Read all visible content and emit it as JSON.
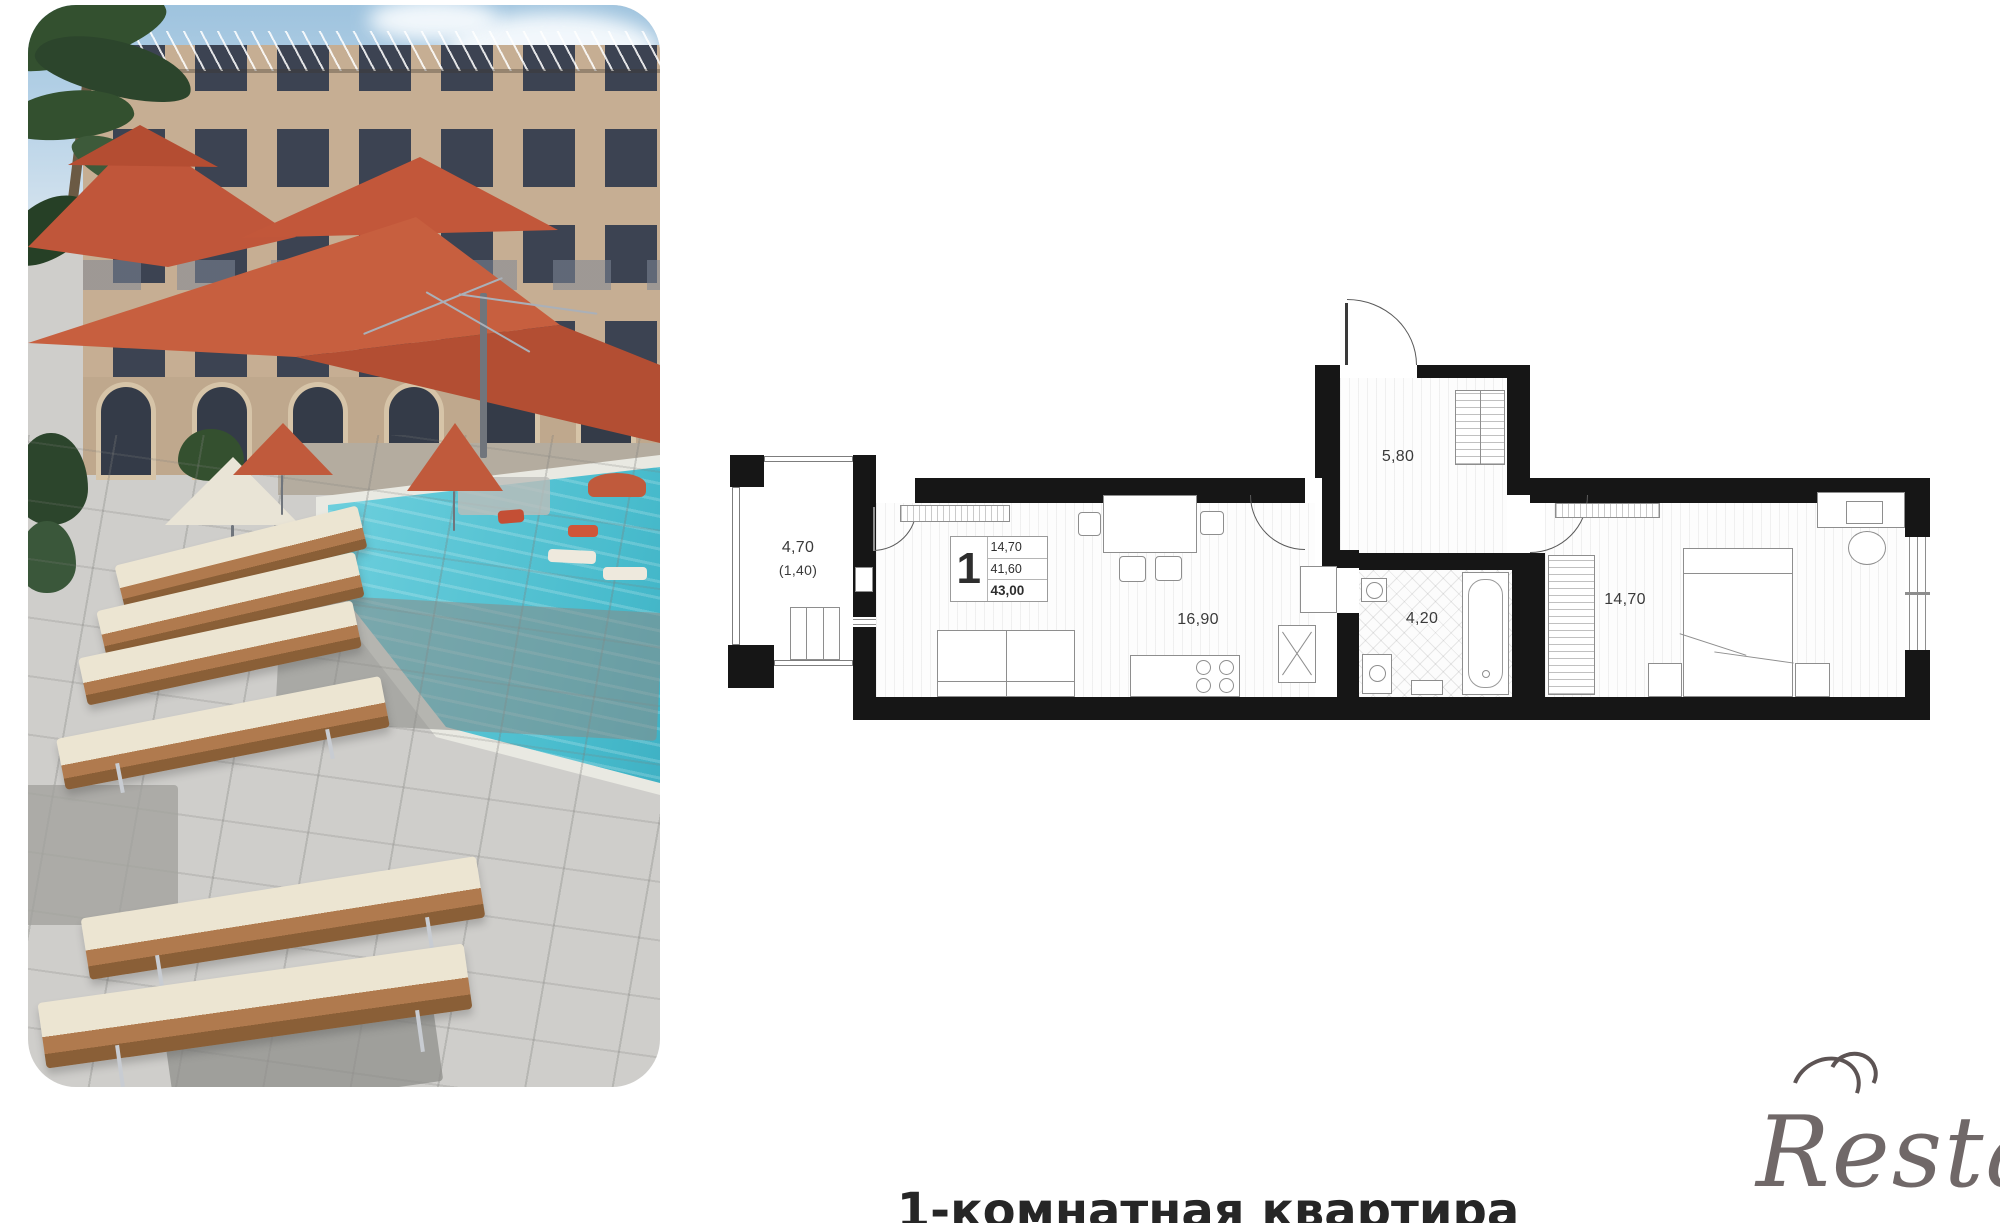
{
  "photo": {
    "colors": {
      "umbrella": "#c75f3f",
      "umbrella_dark": "#b34e33",
      "pool": "#3fb2c6",
      "building": "#c6ae93",
      "window": "#3c4352",
      "paving": "#cfcecb",
      "lounger_cushion": "#ece5d2",
      "lounger_wood": "#b07a4e",
      "sky": "#9ec3de",
      "palm": "#33502f"
    }
  },
  "plan": {
    "balcony": {
      "area": "4,70",
      "area_reduced": "(1,40)"
    },
    "hallway": {
      "area": "5,80"
    },
    "kitchen_living": {
      "area": "16,90"
    },
    "bathroom": {
      "area": "4,20"
    },
    "bedroom": {
      "area": "14,70"
    },
    "info": {
      "rooms": "1",
      "living_area": "14,70",
      "area_without_balcony": "41,60",
      "total_area": "43,00"
    },
    "colors": {
      "wall": "#161616",
      "line": "#8e8e8e"
    }
  },
  "caption": {
    "text": "1-комнатная квартира"
  },
  "watermark": {
    "text": "Restate"
  }
}
